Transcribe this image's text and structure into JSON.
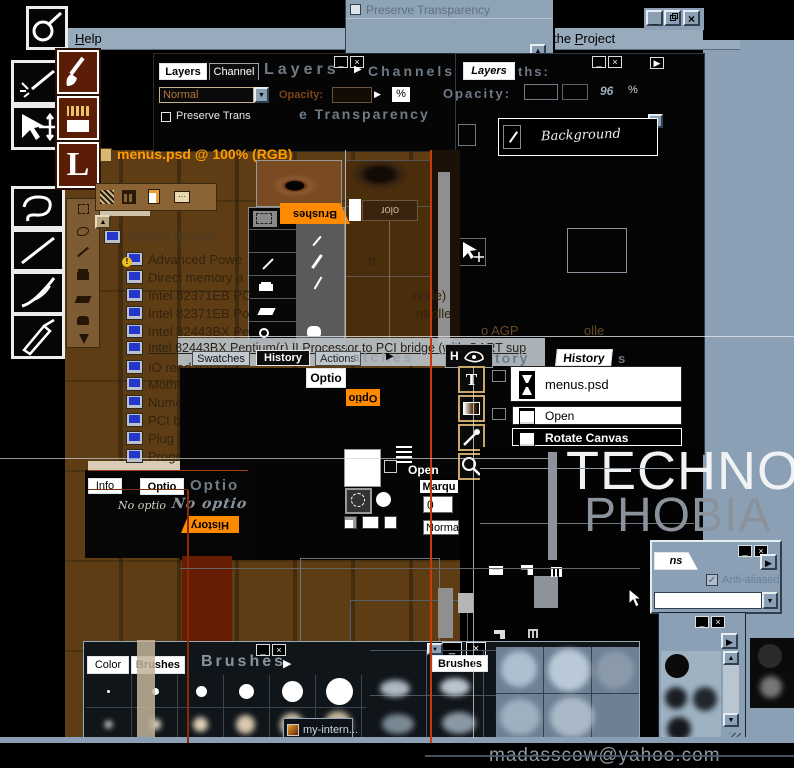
{
  "chrome": {
    "help_initial": "H",
    "help_rest": "elp",
    "project_pre": "the ",
    "project_initial": "P",
    "project_rest": "roject"
  },
  "top_panel": {
    "preserve_transparency": "Preserve Transparency"
  },
  "doc": {
    "title": "menus.psd @ 100% (RGB)"
  },
  "palette1": {
    "tab_layers": "Layers",
    "tab_channel": "Channel",
    "ghost_layers": "Layers",
    "blend_mode": "Normal",
    "opacity_label": "Opacity:",
    "percent": "%",
    "preserve_label": "Preserve Trans",
    "ghost_transparency": "e Transparency"
  },
  "palette2": {
    "ghost_channels": "Channels",
    "tab_layers": "Layers",
    "tab_paths": "ths:",
    "ghost_opacity": "Opacity:",
    "pct_skew": "96",
    "percent": "%",
    "layer_name": "Background"
  },
  "device_tree": {
    "root": "System devices",
    "items": [
      "Advanced Powe",
      "Direct memory a",
      "Intel 82371EB PC",
      "Intel 82371EB Po",
      "Intel 82443BX Pe",
      "Intel 82443BX Pentium(r) II Processor to PCI bridge (with GART sup",
      "IO read data po",
      "Motherboard res",
      "Numeric data pr",
      "PCI bus",
      "Plug and Play B",
      "Programmable i"
    ],
    "fragments": [
      "rt",
      "node)",
      "ntrolle",
      "o AGP",
      "olle"
    ]
  },
  "tabs_row": {
    "swatches": "Swatches",
    "history": "History",
    "actions": "Actions",
    "ghost_atches": "atches",
    "h_initial": "H",
    "ghost_tory": "tory",
    "history2": "History",
    "ghost_s": "s"
  },
  "info_palette": {
    "tab_info": "Info",
    "tab_options": "Optio",
    "ghost_options": "Optio",
    "no_options": "No optio",
    "no_options_ghost": "No optio"
  },
  "flipped": {
    "history": "History",
    "options": "Optio",
    "brushes": "Brushes",
    "color": "olor"
  },
  "center": {
    "options_button": "Optio",
    "open_label": "Open",
    "marquee_label": "Marqu",
    "value": "0",
    "normal_label": "Norma"
  },
  "history_palette": {
    "snapshot": "menus.psd",
    "state_open": "Open",
    "state_rotate": "Rotate Canvas"
  },
  "brand": {
    "line1": "TECHNO",
    "line2": "PHOBIA"
  },
  "options_panel": {
    "tab": "ns",
    "anti_aliased": "Anti-aliased"
  },
  "brushes_palette": {
    "tab_color": "Color",
    "tab_brushes": "Brushes",
    "ghost_brushes": "Brushes",
    "tab_brushes2": "Brushes"
  },
  "taskbar": {
    "item": "my-intern...",
    "email": "madasscow@yahoo.com"
  },
  "icons": {
    "close": "×",
    "minimize": "_",
    "right": "▶",
    "left": "◀",
    "up": "▲",
    "down": "▼",
    "check": "✓",
    "warning": "!"
  },
  "colors": {
    "accent_orange": "#ff8a00",
    "title_orange": "#ff9c00",
    "win_blue_gray": "#8ba0b4",
    "canvas_brown": "#5e3d14",
    "ghost_gray": "#6f7a86",
    "phobia_gray": "#8b929c"
  }
}
